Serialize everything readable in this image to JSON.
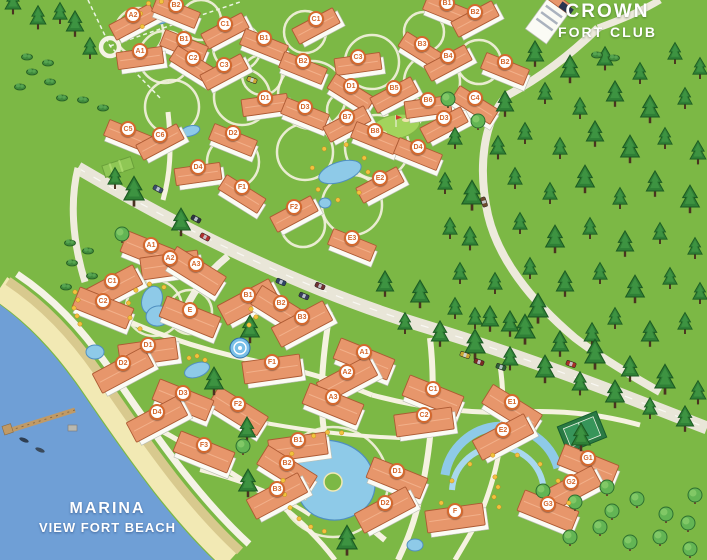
{
  "map": {
    "region_labels": {
      "crown_fort_club": {
        "line1": "CROWN",
        "line2": "FORT CLUB"
      },
      "marina_view_fort_beach": {
        "line1": "MARINA",
        "line2": "VIEW FORT BEACH"
      }
    },
    "badges_upper": [
      {
        "label": "A2",
        "x": 133,
        "y": 15
      },
      {
        "label": "B2",
        "x": 176,
        "y": 5
      },
      {
        "label": "C1",
        "x": 225,
        "y": 24
      },
      {
        "label": "B1",
        "x": 184,
        "y": 39
      },
      {
        "label": "A1",
        "x": 140,
        "y": 51
      },
      {
        "label": "C2",
        "x": 193,
        "y": 58
      },
      {
        "label": "C3",
        "x": 224,
        "y": 65
      },
      {
        "label": "B1",
        "x": 264,
        "y": 38
      },
      {
        "label": "C1",
        "x": 316,
        "y": 19
      },
      {
        "label": "B2",
        "x": 303,
        "y": 61
      },
      {
        "label": "C3",
        "x": 358,
        "y": 57
      },
      {
        "label": "B3",
        "x": 422,
        "y": 44
      },
      {
        "label": "B4",
        "x": 448,
        "y": 56
      },
      {
        "label": "B1",
        "x": 447,
        "y": 3
      },
      {
        "label": "B2",
        "x": 475,
        "y": 12
      },
      {
        "label": "B2",
        "x": 505,
        "y": 62
      },
      {
        "label": "D1",
        "x": 265,
        "y": 98
      },
      {
        "label": "D1",
        "x": 351,
        "y": 86
      },
      {
        "label": "B5",
        "x": 394,
        "y": 88
      },
      {
        "label": "D3",
        "x": 305,
        "y": 107
      },
      {
        "label": "B7",
        "x": 347,
        "y": 117
      },
      {
        "label": "B8",
        "x": 375,
        "y": 131
      },
      {
        "label": "B6",
        "x": 428,
        "y": 100
      },
      {
        "label": "C4",
        "x": 475,
        "y": 98
      },
      {
        "label": "D3",
        "x": 444,
        "y": 118
      },
      {
        "label": "C5",
        "x": 128,
        "y": 129
      },
      {
        "label": "C6",
        "x": 160,
        "y": 135
      },
      {
        "label": "D2",
        "x": 233,
        "y": 133
      },
      {
        "label": "D4",
        "x": 198,
        "y": 167
      },
      {
        "label": "F1",
        "x": 242,
        "y": 187
      },
      {
        "label": "F2",
        "x": 294,
        "y": 207
      },
      {
        "label": "D4",
        "x": 418,
        "y": 147
      },
      {
        "label": "E2",
        "x": 380,
        "y": 178
      },
      {
        "label": "E3",
        "x": 352,
        "y": 238
      }
    ],
    "badges_lower": [
      {
        "label": "A1",
        "x": 151,
        "y": 245
      },
      {
        "label": "A2",
        "x": 170,
        "y": 258
      },
      {
        "label": "A3",
        "x": 196,
        "y": 264
      },
      {
        "label": "C1",
        "x": 112,
        "y": 281
      },
      {
        "label": "C2",
        "x": 103,
        "y": 301
      },
      {
        "label": "B1",
        "x": 248,
        "y": 295
      },
      {
        "label": "E",
        "x": 190,
        "y": 310
      },
      {
        "label": "D1",
        "x": 148,
        "y": 345
      },
      {
        "label": "B2",
        "x": 281,
        "y": 303
      },
      {
        "label": "B3",
        "x": 302,
        "y": 317
      },
      {
        "label": "A1",
        "x": 364,
        "y": 352
      },
      {
        "label": "A2",
        "x": 347,
        "y": 372
      },
      {
        "label": "A3",
        "x": 333,
        "y": 397
      },
      {
        "label": "F1",
        "x": 272,
        "y": 362
      },
      {
        "label": "F2",
        "x": 238,
        "y": 404
      },
      {
        "label": "D2",
        "x": 123,
        "y": 363
      },
      {
        "label": "D3",
        "x": 183,
        "y": 393
      },
      {
        "label": "D4",
        "x": 157,
        "y": 412
      },
      {
        "label": "F3",
        "x": 204,
        "y": 445
      },
      {
        "label": "B1",
        "x": 298,
        "y": 440
      },
      {
        "label": "B2",
        "x": 287,
        "y": 463
      },
      {
        "label": "B3",
        "x": 277,
        "y": 489
      },
      {
        "label": "D1",
        "x": 397,
        "y": 471
      },
      {
        "label": "D2",
        "x": 385,
        "y": 503
      },
      {
        "label": "C1",
        "x": 433,
        "y": 389
      },
      {
        "label": "C2",
        "x": 424,
        "y": 415
      },
      {
        "label": "E1",
        "x": 512,
        "y": 402
      },
      {
        "label": "E2",
        "x": 503,
        "y": 430
      },
      {
        "label": "G1",
        "x": 588,
        "y": 458
      },
      {
        "label": "G2",
        "x": 571,
        "y": 482
      },
      {
        "label": "G3",
        "x": 548,
        "y": 504
      },
      {
        "label": "F",
        "x": 455,
        "y": 511
      }
    ],
    "features": {
      "sea": "sea",
      "beach": "sand-beach",
      "promenade": "beach-promenade",
      "pier": "marina-pier",
      "forest": "pine-forest",
      "main_road": "main-avenue",
      "roundabout": "roundabout",
      "golf_green": "golf-green",
      "tennis_court": "tennis-court",
      "pools": "swimming-pools",
      "spiral_pool": "spiral-pool",
      "sport_field": "sport-field"
    },
    "colors": {
      "grass": "#7cb845",
      "water": "#6f9fd6",
      "sand": "#f2e9b4",
      "tan": "#d8c98e",
      "road": "#e9e6d8",
      "path": "#f5f2e0",
      "roof": "#e7966b",
      "roof_edge": "#ad5a33",
      "body": "#fbfbf5",
      "pine": "#2f8036",
      "pine_dark": "#1c5a22",
      "round_tree": "#63b554",
      "pool": "#8ecae8",
      "pool_edge": "#4f8fc0",
      "badge": "#d4692e",
      "flower": "#f2c23e",
      "label_text": "#ffffff"
    }
  }
}
